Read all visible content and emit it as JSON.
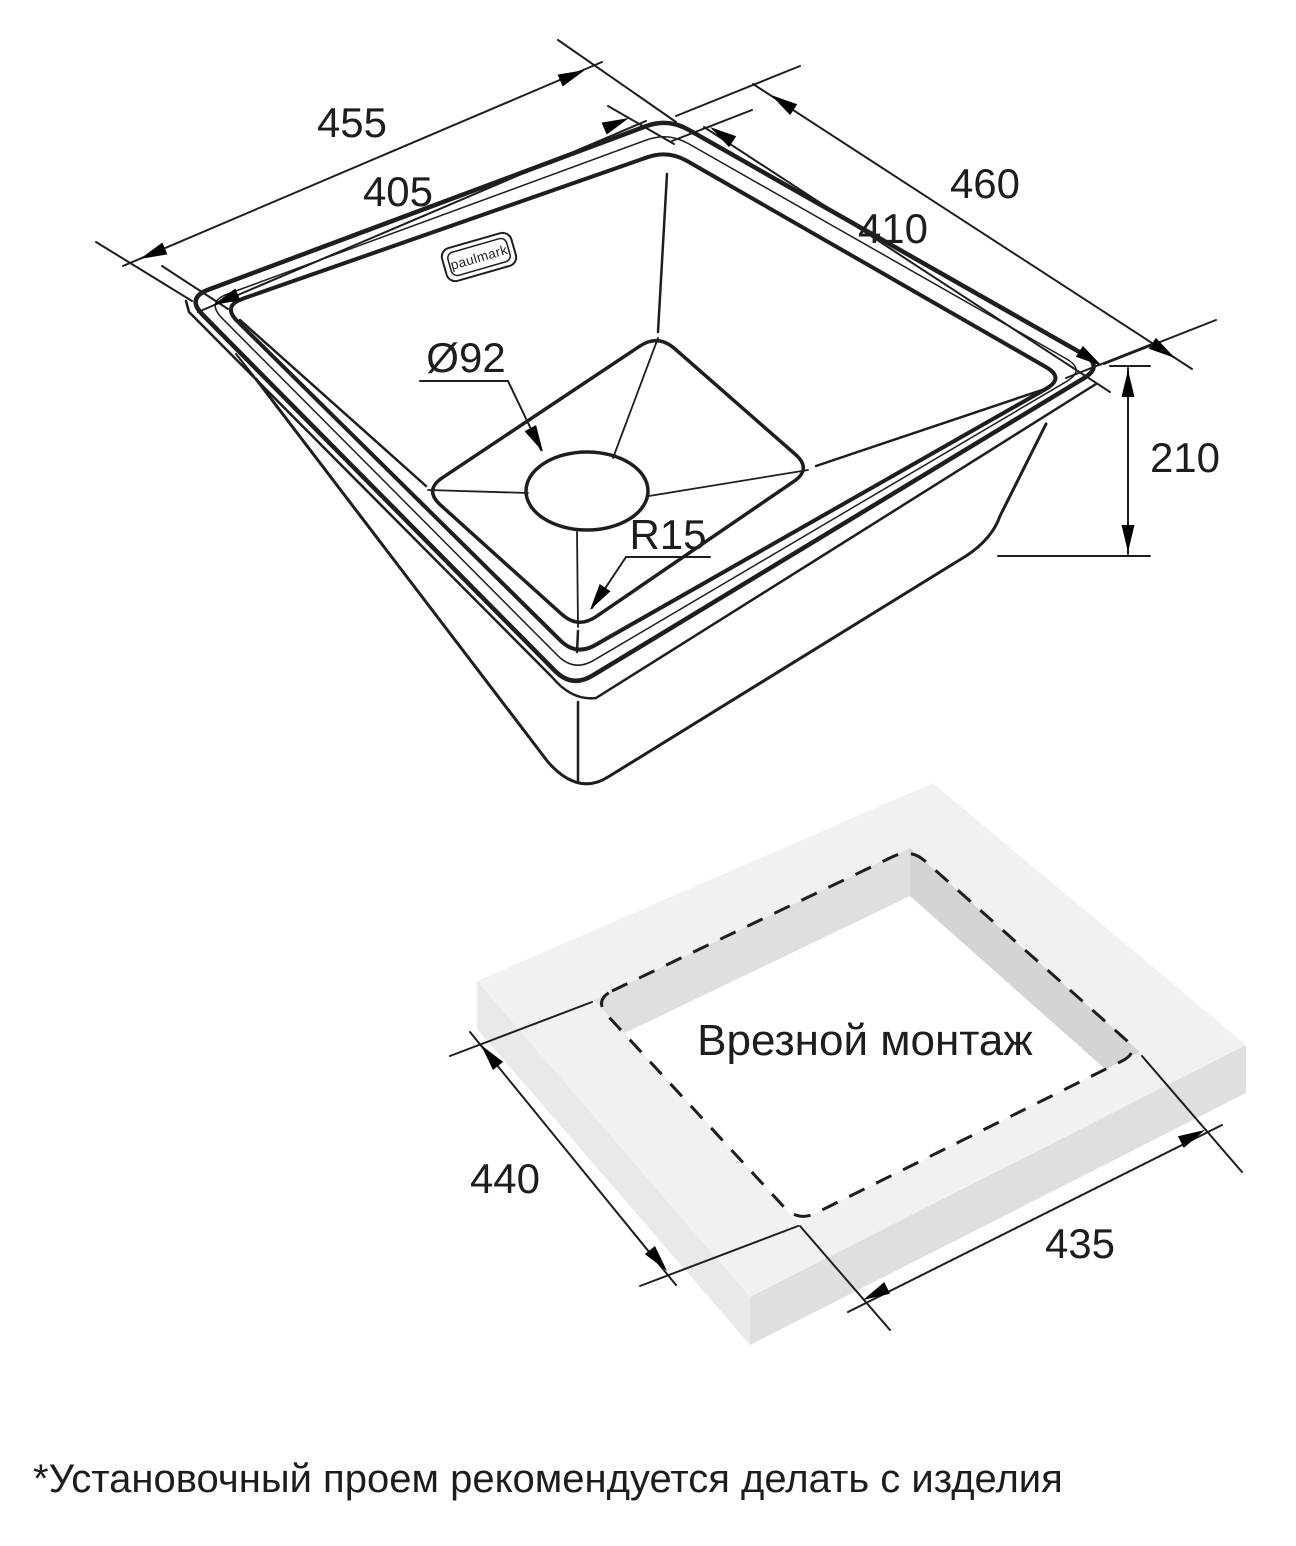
{
  "brand": {
    "logo_text": "paulmark"
  },
  "sink_drawing": {
    "dimensions": {
      "overall_width": "455",
      "bowl_width": "405",
      "overall_depth": "460",
      "bowl_depth": "410",
      "height": "210",
      "drain_diameter": "Ø92",
      "bowl_corner_radius": "R15"
    }
  },
  "cutout_drawing": {
    "label": "Врезной монтаж",
    "dimensions": {
      "width": "440",
      "length": "435"
    }
  },
  "footnote": "*Установочный проем рекомендуется делать с изделия"
}
